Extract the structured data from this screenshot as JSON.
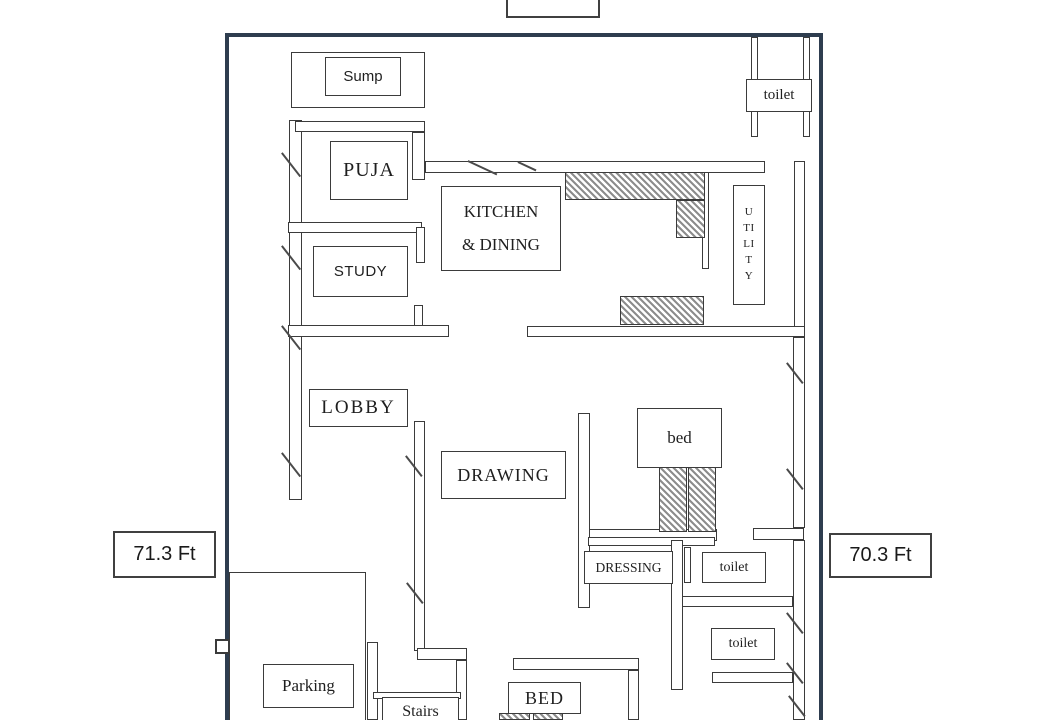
{
  "colors": {
    "outer_border": "#2e3d4f",
    "wall_line": "#3b3b3b"
  },
  "dimensions": {
    "top_label": "45.6 Ft",
    "left_label": "71.3 Ft",
    "right_label": "70.3 Ft"
  },
  "rooms": {
    "sump": {
      "label": "Sump"
    },
    "puja": {
      "label": "PUJA"
    },
    "kitchen": {
      "line1": "KITCHEN",
      "line2": "& DINING"
    },
    "utility": {
      "letters": [
        "U",
        "TI",
        "LI",
        "T",
        "Y"
      ]
    },
    "toilet_top": {
      "label": "toilet"
    },
    "study": {
      "label": "STUDY"
    },
    "lobby": {
      "label": "LOBBY"
    },
    "drawing": {
      "label": "DRAWING"
    },
    "bed_room": {
      "label": "bed"
    },
    "dressing": {
      "label": "DRESSING"
    },
    "toilet_mid": {
      "label": "toilet"
    },
    "toilet_bottom": {
      "label": "toilet"
    },
    "parking": {
      "label": "Parking"
    },
    "stairs": {
      "label": "Stairs"
    },
    "bed_bottom": {
      "label": "BED"
    }
  }
}
